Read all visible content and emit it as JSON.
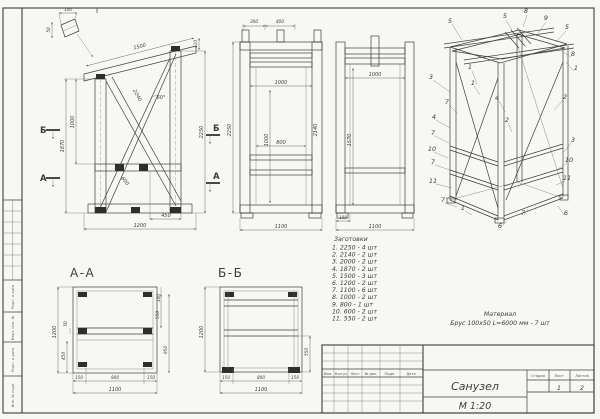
{
  "frame": {
    "strip_box1": "Подп. и дата",
    "strip_box2": "Взам. инв. №",
    "strip_box3": "Подп. и дата",
    "strip_box4": "Инв. № подл."
  },
  "view_front": {
    "detail_w": "100",
    "detail_h": "50",
    "slope": "1500",
    "overhang": "110",
    "dim_left_outer": "1000",
    "dim_left_inner": "1870",
    "dim_right": "2250",
    "diag": "2240",
    "angle": "60°",
    "brace": "600",
    "dim_bottom1": "450",
    "dim_bottom2": "1200",
    "marker_b": "Б",
    "marker_a": "А"
  },
  "view_front2": {
    "dim_top1": "300",
    "dim_top2": "400",
    "dim_width": "1000",
    "dim_door": "800",
    "dim_left": "2250",
    "dim_inner_l": "1000",
    "dim_inner_r": "2140",
    "dim_base": "1100"
  },
  "view_side": {
    "dim_width": "1000",
    "dim_inner": "1570",
    "dim_foot": "100",
    "dim_base": "1100"
  },
  "iso": {
    "callouts": [
      "5",
      "5",
      "8",
      "9",
      "5",
      "8",
      "1",
      "3",
      "1",
      "1",
      "7",
      "4",
      "4",
      "2",
      "2",
      "3",
      "7",
      "10",
      "7",
      "11",
      "7",
      "1",
      "6",
      "7",
      "6",
      "10",
      "11"
    ]
  },
  "section_aa": {
    "title": "А-А",
    "dim_left": "1200",
    "dim_i1": "50",
    "dim_i2": "450",
    "dim_r1": "100",
    "dim_r2": "550",
    "dim_r3": "950",
    "dim_b1": "150",
    "dim_b2": "800",
    "dim_b3": "150",
    "dim_base": "1100"
  },
  "section_bb": {
    "title": "Б-Б",
    "dim_left": "1200",
    "dim_r": "550",
    "dim_b1": "150",
    "dim_b2": "800",
    "dim_b3": "150",
    "dim_base": "1100"
  },
  "parts": {
    "title": "Заготовки",
    "lines": [
      "1. 2250 - 4 шт",
      "2. 2140 - 2 шт",
      "3. 2000 - 2 шт",
      "4. 1870 - 2 шт",
      "5. 1500 - 3 шт",
      "6. 1200 - 2 шт",
      "7. 1100 - 6 шт",
      "8. 1000 - 2 шт",
      "9. 800 - 1 шт",
      "10. 600 - 2 шт",
      "11. 550 - 2 шт"
    ],
    "material_1": "Материал",
    "material_2": "Брус 100х50 L=6000 мм - 7 шт"
  },
  "title_block": {
    "name": "Санузел",
    "scale": "М 1:20",
    "h_izm": "Изм.",
    "h_koluch": "Кол.уч",
    "h_list": "Лист",
    "h_doc": "№ док.",
    "h_podp": "Подп.",
    "h_data": "Дата",
    "h_stage": "Стадия",
    "h_sheet": "Лист",
    "h_sheets": "Листов",
    "sheet": "1",
    "sheets": "2"
  }
}
